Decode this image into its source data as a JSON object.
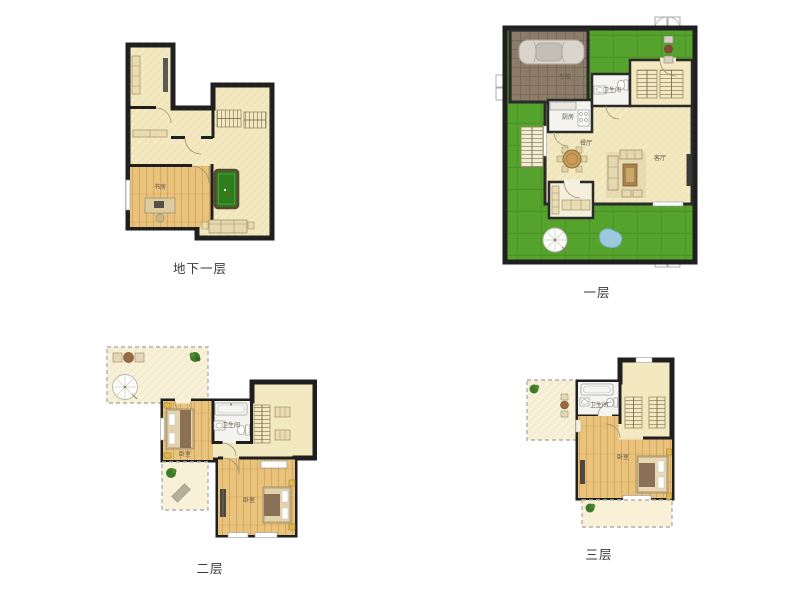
{
  "page": {
    "background": "#ffffff",
    "type": "residential-floor-plan-sheet"
  },
  "colors": {
    "wall": "#1f1f1f",
    "floor_cream": "#f3e9c0",
    "floor_wood": "#e9c27c",
    "room_white": "#f4f4f1",
    "lawn_green": "#55a22c",
    "garage_brown": "#8c7c68",
    "billiard_green": "#2e7d1b",
    "pond_blue": "#9cc8e0",
    "terrace_cream": "#f8f1d8",
    "label_text": "#3a3a3a"
  },
  "floors": {
    "basement": {
      "label": "地下一层",
      "rooms": {
        "study": "书房"
      },
      "features": [
        "bookshelf",
        "storage-cabinet",
        "sideboard",
        "stairs",
        "billiard-table",
        "sofa",
        "desk-with-computer"
      ]
    },
    "first": {
      "label": "一层",
      "rooms": {
        "garage": "车库",
        "bathroom": "卫生间",
        "kitchen": "厨房",
        "dining": "餐厅",
        "living": "客厅"
      },
      "features": [
        "car",
        "entry-double-door",
        "flower-pots",
        "stairs",
        "outdoor-steps",
        "kitchen-counter",
        "stove",
        "toilet",
        "sink",
        "dining-table-with-chairs",
        "sofa-set",
        "coffee-table",
        "tv",
        "porch-benches",
        "garden-parasol",
        "pond",
        "lawn"
      ]
    },
    "second": {
      "label": "二层",
      "rooms": {
        "bedroom_left": "卧室",
        "bathroom": "卫生间",
        "bedroom_main": "卧室"
      },
      "features": [
        "roof-terrace",
        "terrace-chairs-table",
        "parasol",
        "plants",
        "double-bed",
        "nightstands",
        "bathtub",
        "toilet",
        "sink",
        "stairs",
        "bookshelves",
        "wardrobe",
        "window-seat",
        "lounge-mat"
      ]
    },
    "third": {
      "label": "三层",
      "rooms": {
        "bathroom": "卫生间",
        "bedroom": "卧室"
      },
      "features": [
        "roof-terrace",
        "terrace-table-chairs",
        "plants",
        "bathtub",
        "toilet",
        "sink",
        "stairs",
        "double-bed",
        "nightstands",
        "dresser"
      ]
    }
  }
}
